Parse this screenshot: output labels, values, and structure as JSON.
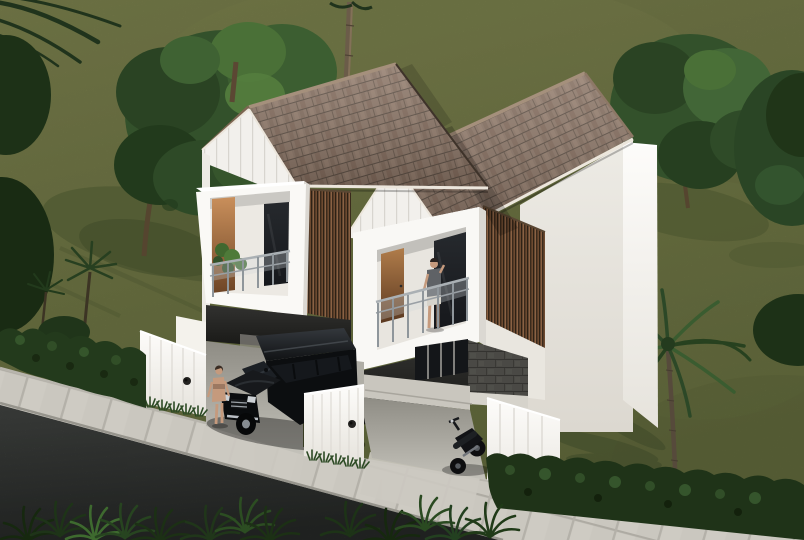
{
  "scene": {
    "title": "3D exterior architectural render of twin two-storey minimalist tropical houses with gabled shingle roofs, wood-slat accents, balconies, a black SUV, a motorcycle, palm trees and a roadside lawn",
    "type": "architectural-exterior-render",
    "objects": [
      "lawn-grass",
      "asphalt-road",
      "paved-sidewalk",
      "driveway-aprons",
      "left-hedge",
      "right-hedge",
      "roadside-plants",
      "left-house",
      "right-house",
      "shingle-gable-roofs",
      "board-and-batten-gables",
      "wood-slat-accent-walls",
      "left-balcony",
      "right-balcony",
      "glass-railings",
      "balcony-plant",
      "man-on-balcony",
      "woman-by-car",
      "black-suv",
      "motorcycle",
      "white-gate-walls",
      "stone-clad-wall",
      "entry-porch",
      "big-tree-left",
      "tree-right",
      "lawn-palm-tree",
      "center-palm-trunk",
      "corner-palm-fronds",
      "edge-shrubs",
      "tree-shadows"
    ]
  },
  "palette": {
    "grassTop": "#7b804d",
    "grassMid": "#6f7645",
    "grassBot": "#636b3d",
    "shadowGreen": "#49532e",
    "treeDark": "#2a4323",
    "treeMid": "#33512b",
    "treeLight": "#4a7037",
    "treeDeep": "#1d3117",
    "trunkBrown": "#55452f",
    "palmTrunk": "#6b5c49",
    "roofBase": "#8c7667",
    "roofGap": "#5c4e43",
    "ridgeCap": "#a5907c",
    "fascia": "#7d6652",
    "trimWhite": "#ece6dc",
    "siding": "#f2f0ec",
    "sidingLine": "#d8d5cf",
    "wallBright": "#fdfcfa",
    "wallShaded": "#edebe5",
    "woodSlatA": "#8a6143",
    "woodSlatB": "#6d4a30",
    "doorWood": "#c98f5b",
    "glassDark": "#16181c",
    "railSteel": "#aab0b4",
    "stoneWall": "#4a4945",
    "concrete": "#c4c2ba",
    "paving": "#cecbc3",
    "grout": "#aeaba3",
    "asphaltHi": "#4f524f",
    "asphaltLo": "#2d302e",
    "carBlack": "#0c0e10",
    "chrome": "#9aa0a6",
    "skinTone": "#c59a7d",
    "shirtGray": "#5f6266",
    "hedgeGreen": "#233a1c"
  }
}
